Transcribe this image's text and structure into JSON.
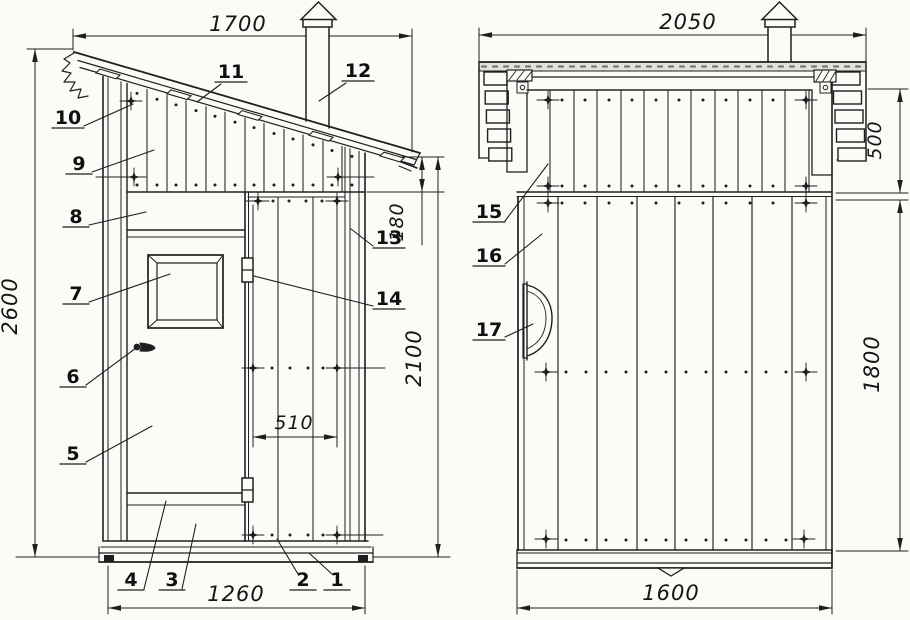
{
  "front_view": {
    "dimensions": {
      "top_width": "1700",
      "overall_height": "2600",
      "eave_height": "180",
      "wall_height": "2100",
      "door_width": "510",
      "base_width": "1260"
    },
    "callouts": [
      "1",
      "2",
      "3",
      "4",
      "5",
      "6",
      "7",
      "8",
      "9",
      "10",
      "11",
      "12",
      "13",
      "14"
    ]
  },
  "side_view": {
    "dimensions": {
      "top_width": "2050",
      "gable_band_height": "500",
      "wall_height": "1800",
      "base_width": "1600"
    },
    "callouts": [
      "15",
      "16",
      "17"
    ]
  },
  "colors": {
    "ink": "#1f1f1f",
    "paper": "#fbfbf8",
    "roof_texture": "#e2e2dd"
  }
}
